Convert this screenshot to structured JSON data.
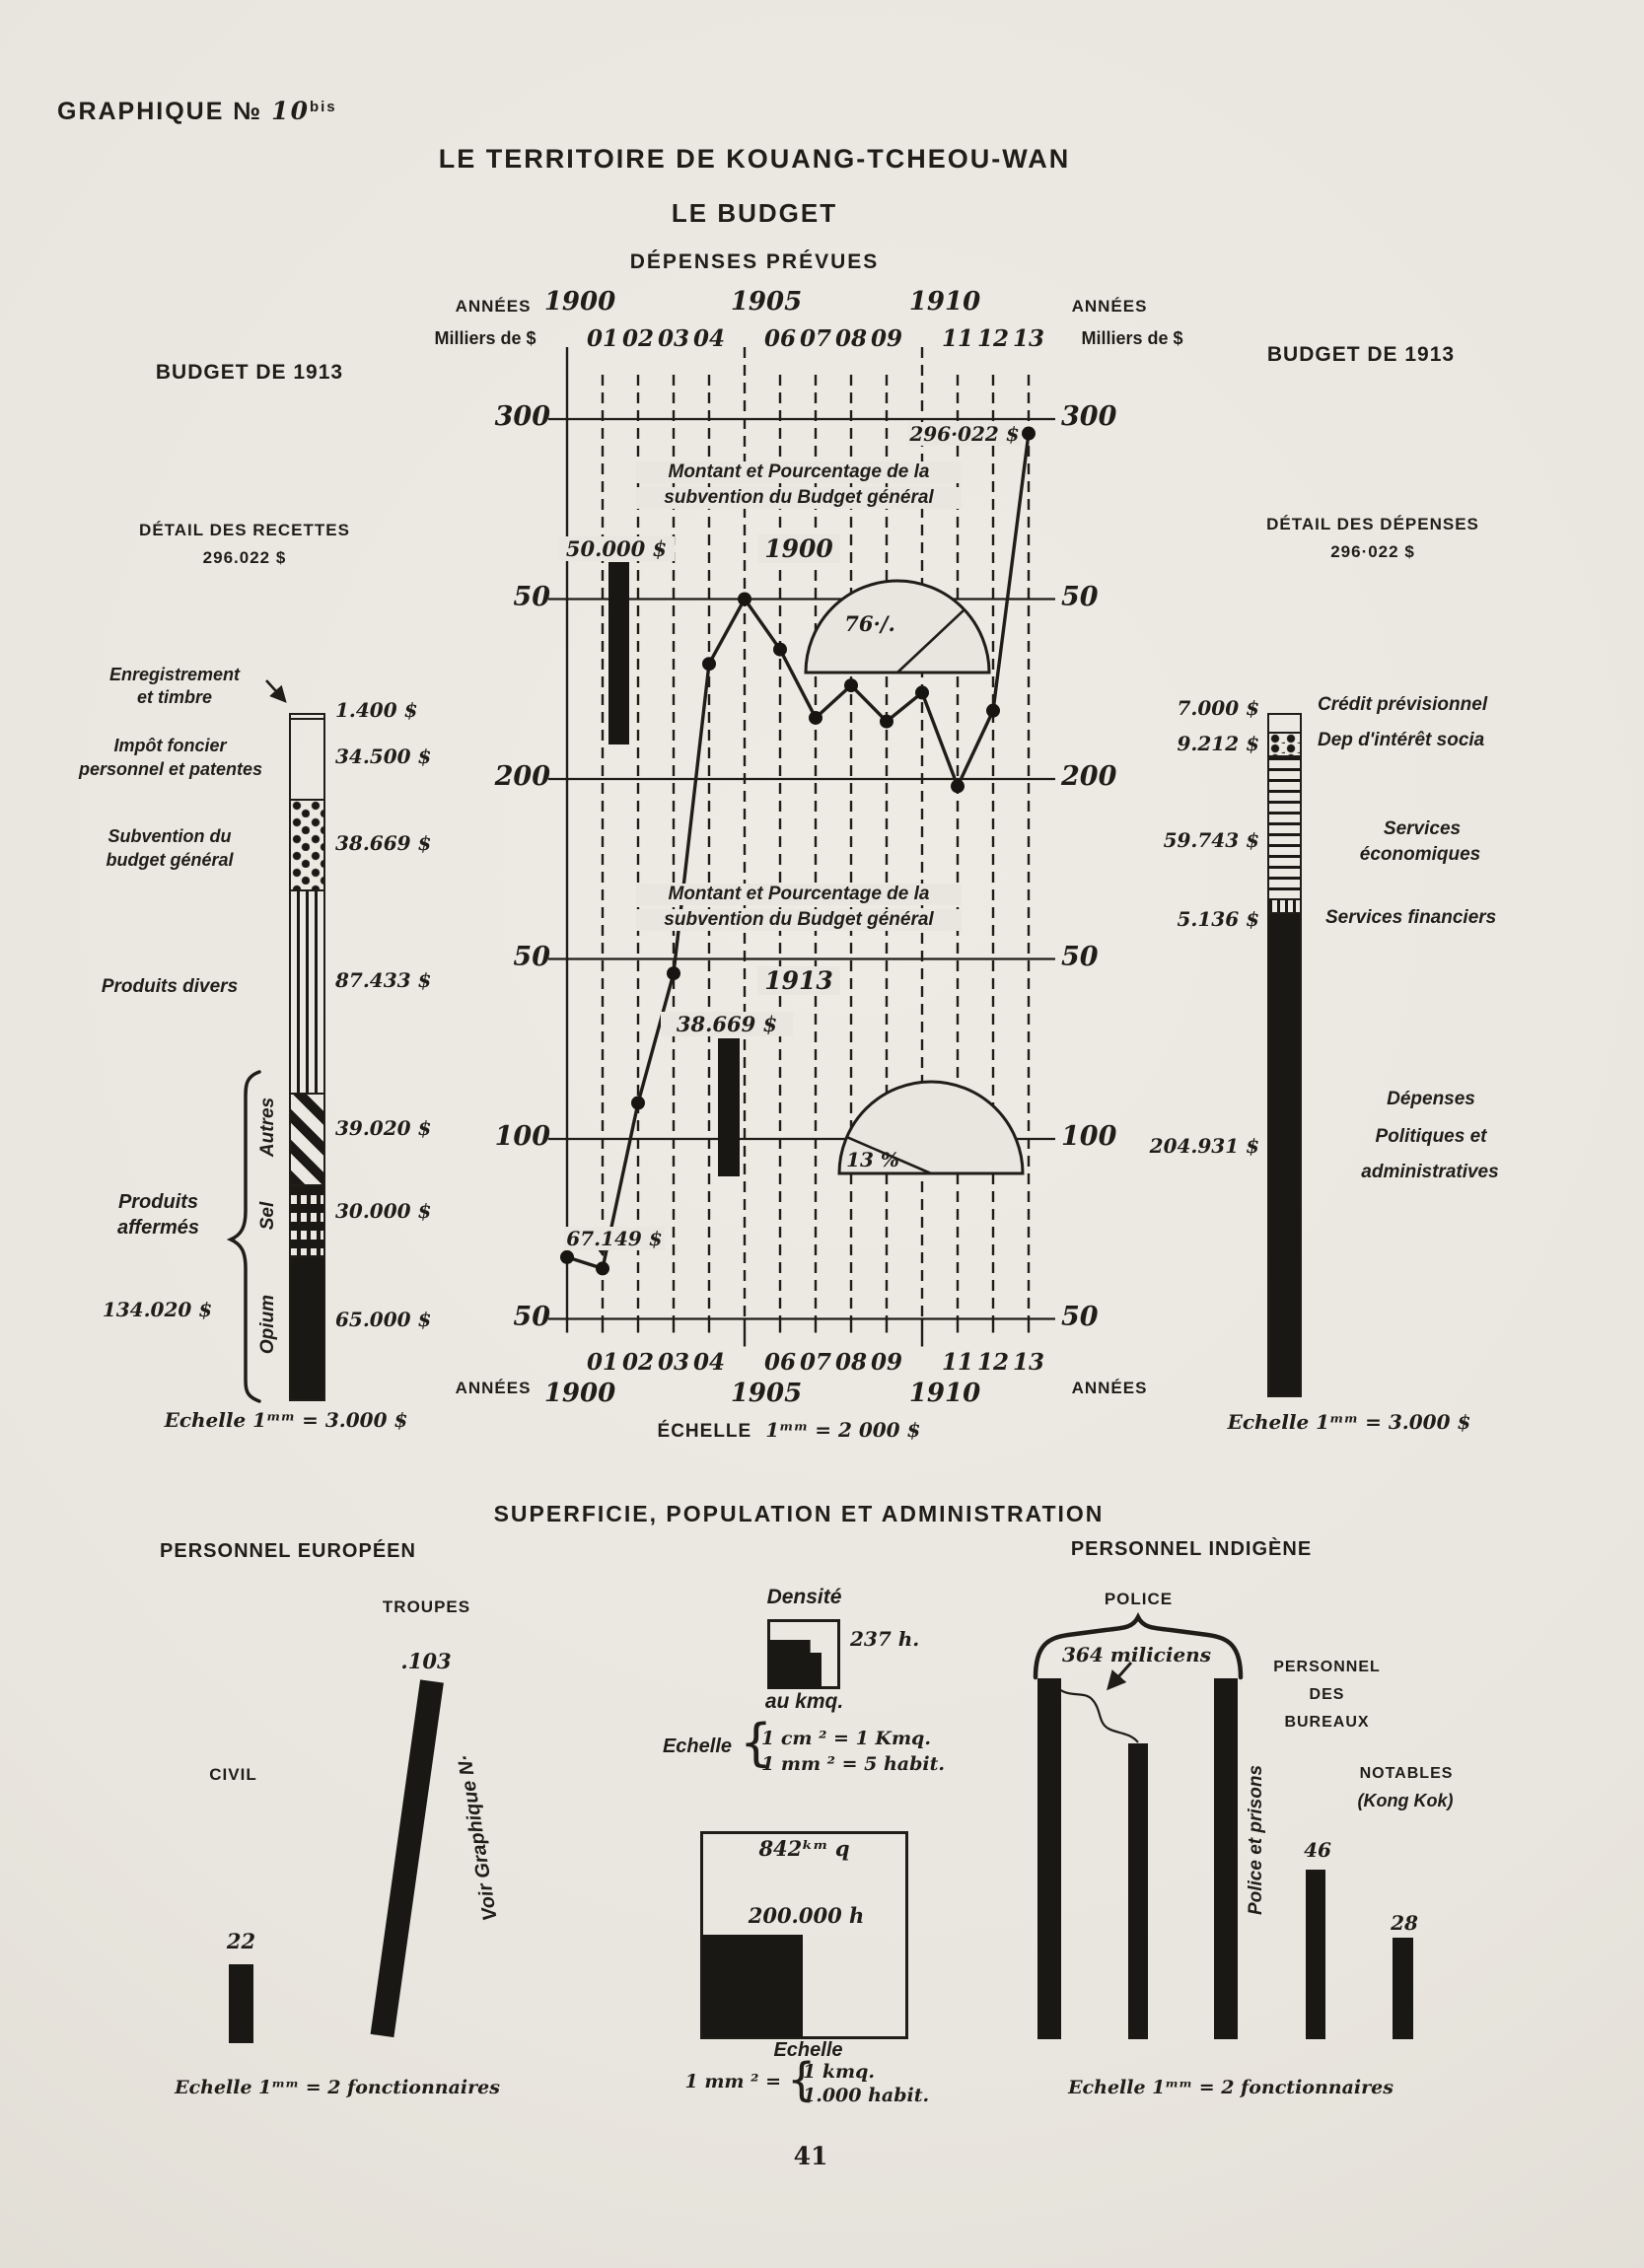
{
  "page": {
    "graphique_label": "GRAPHIQUE №",
    "graphique_num": "10",
    "graphique_sup": "bis",
    "title": "LE TERRITOIRE DE KOUANG-TCHEOU-WAN",
    "subtitle": "LE BUDGET",
    "section_title": "DÉPENSES PRÉVUES",
    "page_number": "41"
  },
  "center": {
    "annees": "ANNÉES",
    "milliers": "Milliers de $",
    "scale_prefix": "ÉCHELLE",
    "scale_rest": "1ᵐᵐ = 2 000 $",
    "decades": [
      "1900",
      "1905",
      "1910"
    ]
  },
  "recettes": {
    "budget_title": "BUDGET DE 1913",
    "detail_title": "DÉTAIL DES RECETTES",
    "total": "296.022 $",
    "scale": "Echelle 1ᵐᵐ = 3.000 $",
    "brace_label1": "Produits",
    "brace_label2": "affermés",
    "brace_value": "134.020 $"
  },
  "depenses": {
    "budget_title": "BUDGET DE 1913",
    "detail_title": "DÉTAIL DES DÉPENSES",
    "total": "296·022 $",
    "scale": "Echelle 1ᵐᵐ = 3.000 $"
  },
  "bottom": {
    "section_title": "SUPERFICIE, POPULATION ET ADMINISTRATION",
    "euro_title": "PERSONNEL EUROPÉEN",
    "voir": "Voir Graphique N·",
    "euro_scale": "Echelle 1ᵐᵐ = 2 fonctionnaires",
    "densite_title": "Densité",
    "densite_value": "237 h.",
    "densite_unit": "au kmq.",
    "densite_echelle": "Echelle",
    "densite_l1": "1 cm ² = 1 Kmq.",
    "densite_l2": "1 mm ² = 5 habit.",
    "surface": "842ᵏᵐ q",
    "population": "200.000 h",
    "box_echelle": "Echelle",
    "box_prefix": "1 mm ² =",
    "box_l1": "1 kmq.",
    "box_l2": "1.000 habit.",
    "brace_glyph": "{",
    "indig_title": "PERSONNEL INDIGÈNE",
    "police_label": "POLICE",
    "police_prisons": "Police et prisons",
    "bureaux1": "PERSONNEL",
    "bureaux2": "DES",
    "bureaux3": "BUREAUX",
    "notables1": "NOTABLES",
    "notables2": "(Kong Kok)",
    "indig_scale": "Echelle 1ᵐᵐ = 2 fonctionnaires"
  },
  "chart_data": [
    {
      "type": "line",
      "title": "DÉPENSES PRÉVUES",
      "xlabel": "ANNÉES",
      "ylabel": "Milliers de $",
      "ylim": [
        50,
        300
      ],
      "x": [
        "1900",
        "01",
        "02",
        "03",
        "04",
        "1905",
        "06",
        "07",
        "08",
        "09",
        "1910",
        "11",
        "12",
        "13"
      ],
      "values_milliers": [
        67.149,
        64,
        110,
        146,
        232,
        250,
        236,
        217,
        226,
        216,
        224,
        198,
        219,
        296.022
      ],
      "yticks": [
        {
          "label": "300",
          "value": 300
        },
        {
          "label": "50",
          "value": 250
        },
        {
          "label": "200",
          "value": 200
        },
        {
          "label": "50",
          "value": 150
        },
        {
          "label": "100",
          "value": 100
        },
        {
          "label": "50",
          "value": 50
        }
      ],
      "year_ticks": [
        "01",
        "02",
        "03",
        "04",
        "06",
        "07",
        "08",
        "09",
        "11",
        "12",
        "13"
      ],
      "first_point_label": "67.149 $",
      "last_point_label": "296·022 $",
      "scale": "ÉCHELLE 1ᵐᵐ = 2 000 $",
      "insets": [
        {
          "line1": "Montant et Pourcentage de la",
          "line2": "subvention du Budget général",
          "year": "1900",
          "bar_label": "50.000 $",
          "pie_label": "76·/.",
          "pie_pct": 76
        },
        {
          "line1": "Montant et  Pourcentage de la",
          "line2": "subvention du  Budget général",
          "year": "1913",
          "bar_label": "38.669 $",
          "pie_label": "13 %",
          "pie_pct": 13
        }
      ]
    },
    {
      "type": "bar",
      "stacked": true,
      "title": "DÉTAIL DES RECETTES",
      "total": 296022,
      "segments": [
        {
          "label1": "Enregistrement",
          "label2": "et timbre",
          "value_label": "1.400 $",
          "value": 1400,
          "pattern": "white"
        },
        {
          "label1": "Impôt foncier",
          "label2": "personnel et patentes",
          "value_label": "34.500 $",
          "value": 34500,
          "pattern": "white"
        },
        {
          "label1": "Subvention du",
          "label2": "budget général",
          "value_label": "38.669 $",
          "value": 38669,
          "pattern": "dots"
        },
        {
          "label1": "Produits divers",
          "label2": "",
          "value_label": "87.433 $",
          "value": 87433,
          "pattern": "vlines"
        },
        {
          "label1": "Autres",
          "label2": "",
          "value_label": "39.020 $",
          "value": 39020,
          "pattern": "diag"
        },
        {
          "label1": "Sel",
          "label2": "",
          "value_label": "30.000 $",
          "value": 30000,
          "pattern": "check"
        },
        {
          "label1": "Opium",
          "label2": "",
          "value_label": "65.000 $",
          "value": 65000,
          "pattern": "solid"
        }
      ]
    },
    {
      "type": "bar",
      "stacked": true,
      "title": "DÉTAIL DES DÉPENSES",
      "total": 286022,
      "segments": [
        {
          "label1": "Crédit prévisionnel",
          "label2": "",
          "value_label": "7.000 $",
          "value": 7000,
          "pattern": "white"
        },
        {
          "label1": "Dep  d'intérêt socia",
          "label2": "",
          "value_label": "9.212 $",
          "value": 9212,
          "pattern": "dots"
        },
        {
          "label1": "Services",
          "label2": "économiques",
          "value_label": "59.743 $",
          "value": 59743,
          "pattern": "hlines"
        },
        {
          "label1": "Services financiers",
          "label2": "",
          "value_label": "5.136 $",
          "value": 5136,
          "pattern": "vdash"
        },
        {
          "label1": "Dépenses",
          "label2": "Politiques et",
          "label3": "administratives",
          "value_label": "204.931 $",
          "value": 204931,
          "pattern": "solid"
        }
      ]
    },
    {
      "type": "bar",
      "title": "PERSONNEL EUROPÉEN",
      "categories": [
        "CIVIL",
        "TROUPES"
      ],
      "values": [
        22,
        103
      ],
      "value_labels": [
        "22",
        ".103"
      ],
      "scale": "1 mm = 2 fonctionnaires"
    },
    {
      "type": "bar",
      "title": "PERSONNEL INDIGÈNE",
      "categories": [
        "POLICE",
        "PERSONNEL DES BUREAUX",
        "NOTABLES (Kong Kok)"
      ],
      "values": [
        364,
        46,
        28
      ],
      "value_labels": [
        "364 miliciens",
        "46",
        "28"
      ],
      "scale": "1 mm = 2 fonctionnaires"
    },
    {
      "type": "table",
      "title": "SUPERFICIE, POPULATION",
      "superficie_kmq": 842,
      "population_h": 200000,
      "densite_h_au_kmq": 237
    }
  ]
}
